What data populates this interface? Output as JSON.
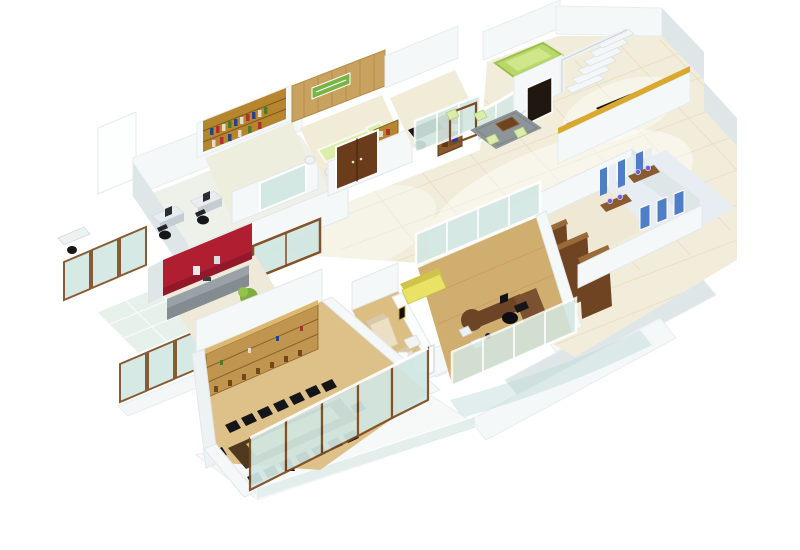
{
  "title": "3D isometric render of an office floor plan",
  "palette": {
    "wall": "#f5f8f8",
    "wallShade": "#dfe6e8",
    "wallDark": "#c9d2d5",
    "floorTile": "#f2edda",
    "floorLight": "#fbf8ef",
    "grout": "#e4dcc3",
    "woodFloor": "#dcbd82",
    "woodFloorDark": "#d0ae6f",
    "wood": "#c8a25e",
    "shelfWood": "#b5862e",
    "shelfDark": "#7c5a1e",
    "doorWood": "#6b3c1b",
    "glassFrame": "#7c4a20",
    "glass": "#d2e7e2",
    "glassDeep": "#bcd9d6",
    "red": "#b01e31",
    "redDark": "#871627",
    "counterGray": "#9aa2a8",
    "green": "#79b445",
    "liftGreen": "#b9d86a",
    "greenLight": "#dcedaa",
    "yellow": "#e9e264",
    "yellowDark": "#cfc44a",
    "black": "#15151a",
    "gray": "#8d9598",
    "blue": "#4e7ec5",
    "purple": "#6f5fd0",
    "gold": "#d9a82e",
    "cream": "#ecdfc6",
    "creamDark": "#d9c9a8",
    "tableDark": "#4f3a1e",
    "tableInlay": "#d9b97c",
    "cabinetBrown": "#6e4422"
  },
  "scene": {
    "type": "3d-floor-plan-render",
    "background": "#ffffff",
    "rooms": [
      {
        "id": "workstation-area",
        "label": "open workstations with four desks"
      },
      {
        "id": "library",
        "label": "library room with wall shelves"
      },
      {
        "id": "reception",
        "label": "reception with wood panel wall and green signboard"
      },
      {
        "id": "office-cabin",
        "label": "small office cabin with black desk"
      },
      {
        "id": "lift-and-stairs",
        "label": "green lift shaft and staircase"
      },
      {
        "id": "waiting-area",
        "label": "lobby waiting area with rug and poufs"
      },
      {
        "id": "storage-room",
        "label": "storage room with tall wooden cabinets"
      },
      {
        "id": "washrooms",
        "label": "washrooms with blue stall partitions"
      },
      {
        "id": "pantry",
        "label": "pantry with red wall and counter"
      },
      {
        "id": "lounge",
        "label": "lounge with two cream sofas"
      },
      {
        "id": "manager-cabin",
        "label": "manager cabin with L-desk and yellow sofa"
      },
      {
        "id": "conference-room",
        "label": "conference room with long table"
      },
      {
        "id": "balcony",
        "label": "glass balcony terrace"
      },
      {
        "id": "facade",
        "label": "stepped white facade with windows"
      }
    ],
    "counts": {
      "workstation_desks": 4,
      "conference_chairs": 16,
      "lounge_sofas": 2,
      "storage_cabinets": 3,
      "balcony_glass_panels": 6,
      "conference_glass_panels": 5
    }
  }
}
